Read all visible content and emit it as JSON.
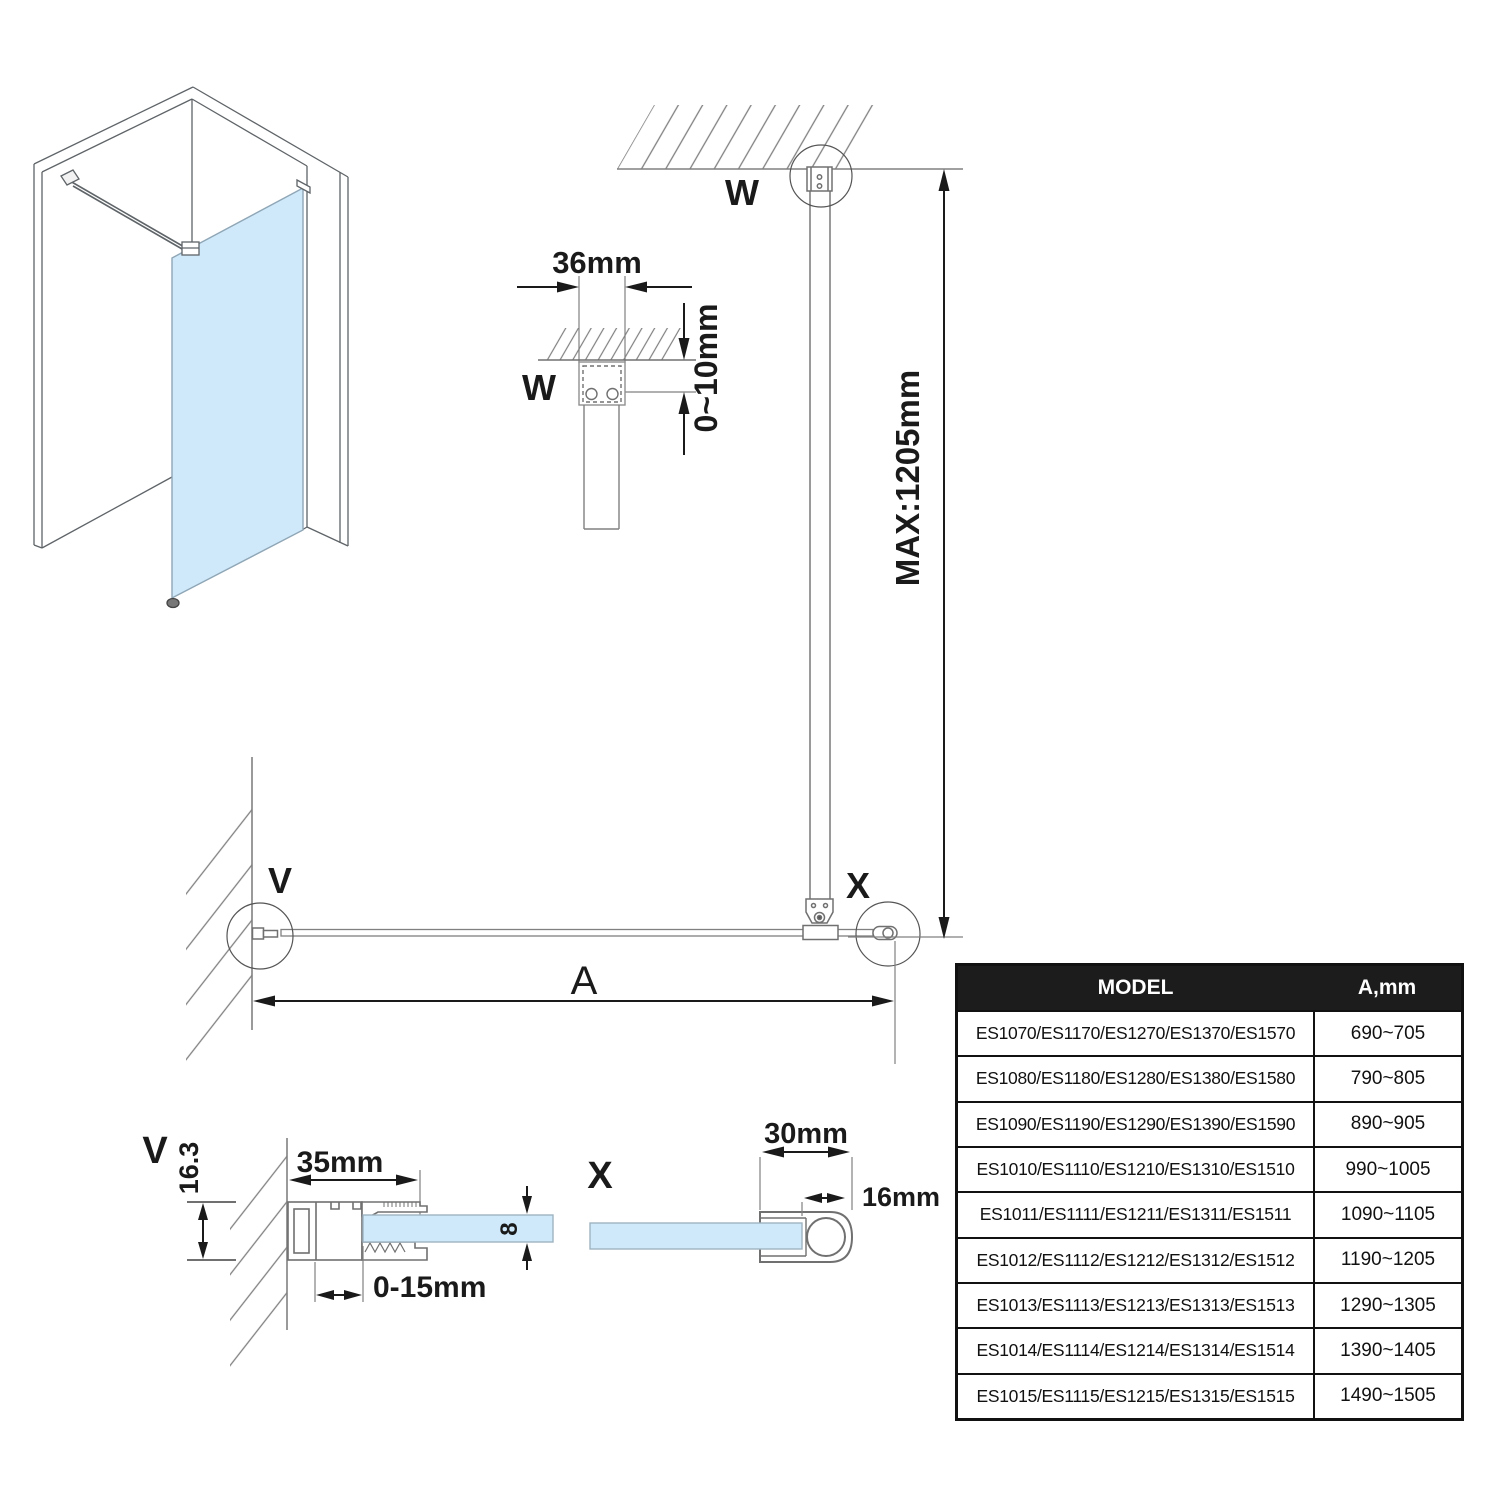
{
  "labels": {
    "w_top": "W",
    "w_detail": "W",
    "v_plan": "V",
    "x_plan": "X",
    "v_section": "V",
    "x_section": "X",
    "dim_bracket_width": "36mm",
    "dim_ceiling_gap": "0~10mm",
    "dim_max_height": "MAX:1205mm",
    "dim_width_letter": "A",
    "dim_wall_profile_width": "35mm",
    "dim_wall_profile_height": "16.3",
    "dim_glass_thickness": "8",
    "dim_adjustment": "0-15mm",
    "dim_endcap_width": "30mm",
    "dim_endcap_depth": "16mm"
  },
  "table": {
    "headers": {
      "model": "MODEL",
      "a": "A,mm"
    },
    "rows": [
      {
        "model": "ES1070/ES1170/ES1270/ES1370/ES1570",
        "a": "690~705"
      },
      {
        "model": "ES1080/ES1180/ES1280/ES1380/ES1580",
        "a": "790~805"
      },
      {
        "model": "ES1090/ES1190/ES1290/ES1390/ES1590",
        "a": "890~905"
      },
      {
        "model": "ES1010/ES1110/ES1210/ES1310/ES1510",
        "a": "990~1005"
      },
      {
        "model": "ES1011/ES1111/ES1211/ES1311/ES1511",
        "a": "1090~1105"
      },
      {
        "model": "ES1012/ES1112/ES1212/ES1312/ES1512",
        "a": "1190~1205"
      },
      {
        "model": "ES1013/ES1113/ES1213/ES1313/ES1513",
        "a": "1290~1305"
      },
      {
        "model": "ES1014/ES1114/ES1214/ES1314/ES1514",
        "a": "1390~1405"
      },
      {
        "model": "ES1015/ES1115/ES1215/ES1315/ES1515",
        "a": "1490~1505"
      }
    ]
  },
  "colors": {
    "glass": "#cfe9fa",
    "line_gray": "#808080",
    "ink": "#1a1a1a",
    "table_header_bg": "#1c1c1c",
    "table_header_text": "#ffffff"
  }
}
